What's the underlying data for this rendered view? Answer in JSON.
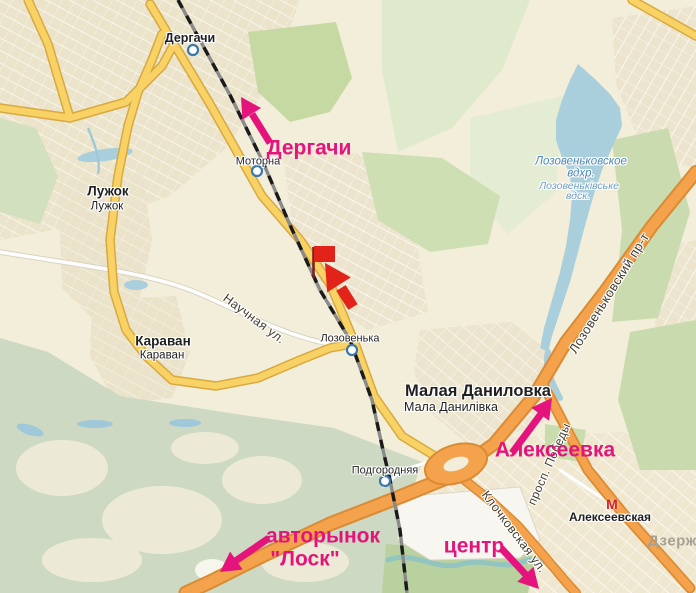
{
  "map_title": "Map of north-west Kharkiv area with route annotations",
  "colors": {
    "annotation_pink": "#e5137c",
    "marker_red": "#e1231a",
    "marker_pole": "#7d231a",
    "metro_red": "#cf2128",
    "water": "#a9cfdd",
    "road_yellow": "#f8d264",
    "road_yellow_border": "#d9a93f",
    "road_orange": "#f4a24c",
    "road_orange_border": "#da8b34",
    "railway_dash": "#1a1a1a",
    "urban": "#ebe3ca",
    "forest_green": "#c9dcae",
    "background": "#f2eeda"
  },
  "towns": {
    "dergachi": "Дергачи",
    "luzhok_ru": "Лужок",
    "luzhok_ua": "Лужок",
    "karavan_ru": "Караван",
    "karavan_ua": "Караван",
    "malaya_danilovka_ru": "Малая Даниловка",
    "malaya_danilovka_ua": "Мала Данилівка"
  },
  "stations": {
    "motorna": "Моторна",
    "lozovenka": "Лозовенька",
    "podgorodnyaya": "Подгородняя"
  },
  "metro": {
    "alekseevskaya": "Алексеевская",
    "icon_letter": "М"
  },
  "district": {
    "dzerzh": "Дзерж"
  },
  "water_labels": {
    "line1": "Лозовеньковское",
    "line2": "вдхр.",
    "line3": "Лозовеньківське",
    "line4": "вдск."
  },
  "streets": {
    "nauchnaya": "Научная ул.",
    "lozovenkovsky": "Лозовеньковский пр-т",
    "pobedy": "просп. Победы",
    "klochkovskaya": "Клочковская ул."
  },
  "annotations": {
    "dergachi": "Дергачи",
    "alekseevka": "Алексеевка",
    "avtorynok_line1": "авторынок",
    "avtorynok_line2": "\"Лоск\"",
    "centr": "центр"
  }
}
